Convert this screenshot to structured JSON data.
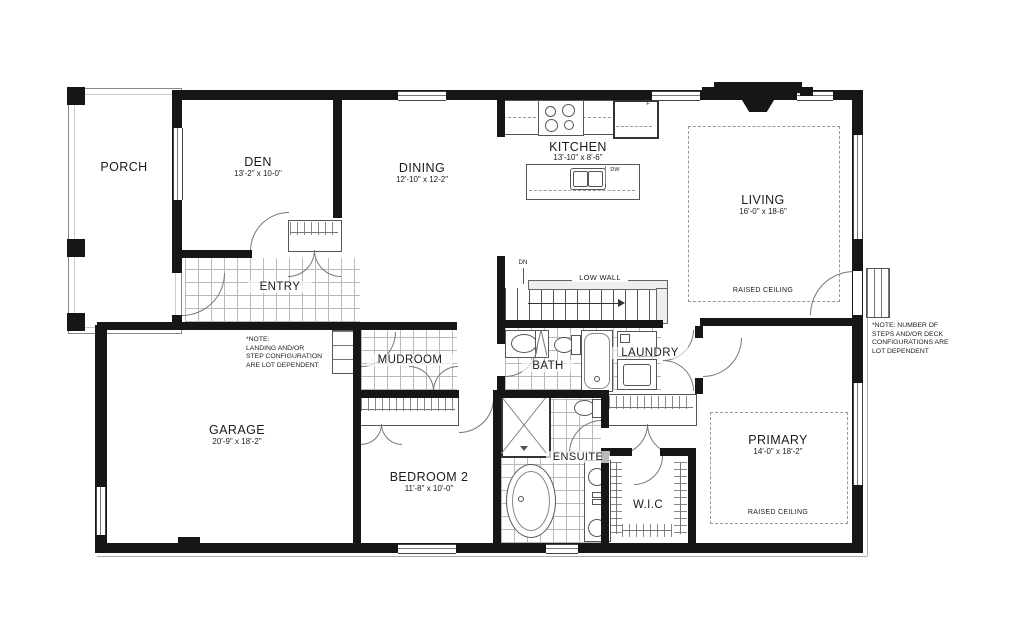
{
  "rooms": {
    "porch": {
      "name": "PORCH"
    },
    "den": {
      "name": "DEN",
      "dims": "13'-2\" x 10-0\""
    },
    "dining": {
      "name": "DINING",
      "dims": "12'-10\" x 12-2\""
    },
    "kitchen": {
      "name": "KITCHEN",
      "dims": "13'-10\" x 8'-6\""
    },
    "living": {
      "name": "LIVING",
      "dims": "16'-0\" x 18-6\"",
      "ceiling": "RAISED CEILING"
    },
    "entry": {
      "name": "ENTRY"
    },
    "mudroom": {
      "name": "MUDROOM"
    },
    "bath": {
      "name": "BATH"
    },
    "laundry": {
      "name": "LAUNDRY"
    },
    "garage": {
      "name": "GARAGE",
      "dims": "20'-9\" x 18'-2\""
    },
    "bedroom2": {
      "name": "BEDROOM 2",
      "dims": "11'-8\" x 10'-0\""
    },
    "ensuite": {
      "name": "ENSUITE"
    },
    "wic": {
      "name": "W.I.C"
    },
    "primary": {
      "name": "PRIMARY",
      "dims": "14'-0\" x 18'-2\"",
      "ceiling": "RAISED CEILING"
    }
  },
  "annotations": {
    "low_wall": "LOW WALL",
    "dn": "DN",
    "dw": "DW",
    "fridge": "F",
    "note_landing": "*NOTE:\nLANDING AND/OR\nSTEP CONFIGURATION\nARE LOT DEPENDENT",
    "note_steps": "*NOTE: NUMBER OF\nSTEPS AND/OR DECK\nCONFIGURATIONS ARE\nLOT DEPENDENT"
  },
  "colors": {
    "wall": "#161616",
    "tile_line": "#b9b9b9",
    "door_arc": "#777777"
  }
}
